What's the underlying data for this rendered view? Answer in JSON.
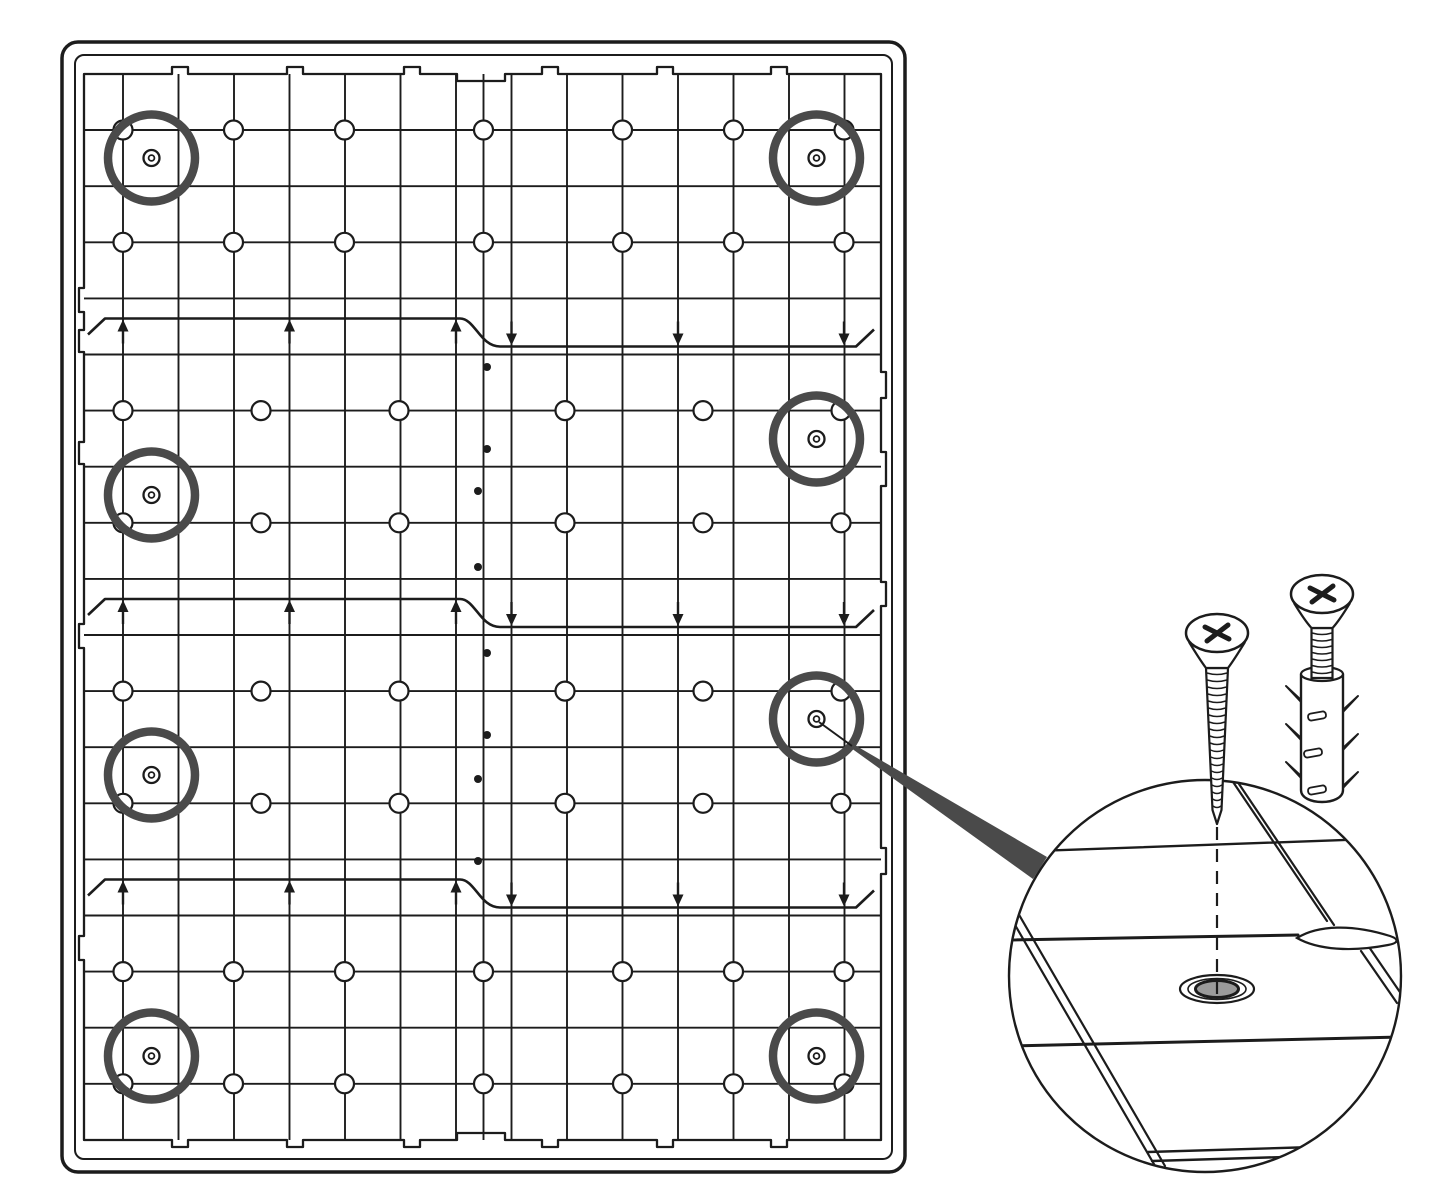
{
  "figure": {
    "type": "panel-mounting-instruction-diagram",
    "canvas": {
      "width": 1445,
      "height": 1200
    },
    "colors": {
      "background": "#ffffff",
      "line": "#1c1c1c",
      "accent": "#4a4a4a",
      "hole_fill": "#9b9b9b"
    },
    "style": {
      "grid_stroke": 1.9,
      "tile_stroke": 2.3,
      "joint_stroke": 2.6,
      "outer_frame_stroke": 3.5,
      "inner_frame_stroke": 2,
      "detail_circle_stroke": 2.4
    },
    "panel": {
      "outer_frame": {
        "x": 62,
        "y": 42,
        "w": 843,
        "h": 1130,
        "radius": 16
      },
      "inner_frame": {
        "x": 75,
        "y": 55,
        "w": 817,
        "h": 1104,
        "radius": 9
      },
      "tile_area": {
        "x": 84,
        "y": 74,
        "w": 797,
        "h": 1066
      },
      "edge_features": {
        "tab_depth": 7,
        "tab_halfwidth": 8,
        "step_out": 5,
        "top": [
          {
            "tab": 180
          },
          {
            "tab": 295
          },
          {
            "tab": 412
          },
          {
            "recess": [
              457,
              505
            ]
          },
          {
            "tab": 550
          },
          {
            "tab": 665
          },
          {
            "tab": 779
          }
        ],
        "right_steps": [
          [
            372,
            398
          ],
          [
            452,
            486
          ],
          [
            582,
            606
          ],
          [
            848,
            874
          ]
        ],
        "left_steps": [
          [
            288,
            312
          ],
          [
            330,
            352
          ],
          [
            442,
            464
          ],
          [
            624,
            648
          ],
          [
            936,
            960
          ]
        ]
      },
      "grid": {
        "vertical_lines_x": [
          123,
          178.5,
          234,
          289.5,
          345,
          400.5,
          456,
          511.5,
          567,
          622.5,
          678,
          733.5,
          789,
          844.5
        ],
        "seam_x": 483.5,
        "horizontal_lines_y": [
          130,
          186.2,
          242.3,
          298.4,
          354.5,
          410.6,
          466.7,
          522.8,
          578.9,
          635,
          691.1,
          747.2,
          803.3,
          859.4,
          915.5,
          971.6,
          1027.7,
          1083.8
        ]
      },
      "section_boundaries": [
        {
          "left_y": 318.5,
          "right_y": 346.5
        },
        {
          "left_y": 599,
          "right_y": 627
        },
        {
          "left_y": 879.5,
          "right_y": 907.5
        }
      ],
      "boundary_shape": {
        "x_start": 88,
        "step_x1": 460,
        "step_x2": 500,
        "x_end": 856,
        "up_arrow_xs": [
          123,
          289.5,
          456
        ],
        "down_arrow_xs": [
          511.5,
          678,
          844
        ]
      },
      "peg_circles": {
        "radius": 9.5,
        "rows_wide": [
          130,
          242.3,
          971.6,
          1083.8
        ],
        "cols_wide": [
          123,
          233.5,
          344.5,
          483.5,
          622.5,
          733.5,
          844
        ],
        "rows_narrow": [
          410.6,
          522.8,
          691.1,
          803.3
        ],
        "cols_narrow": [
          123,
          261,
          399,
          565,
          703,
          841
        ]
      },
      "seam_dots": [
        [
          487,
          367
        ],
        [
          487,
          449
        ],
        [
          478,
          491
        ],
        [
          478,
          567
        ],
        [
          487,
          653
        ],
        [
          487,
          735
        ],
        [
          478,
          779
        ],
        [
          478,
          861
        ]
      ],
      "screw_positions": {
        "ring_radius": 43.5,
        "ring_stroke": 8.5,
        "marker_outer_r": 8,
        "marker_inner_r": 2.9,
        "centers": [
          [
            151.5,
            158
          ],
          [
            816.5,
            158
          ],
          [
            816.5,
            439
          ],
          [
            151.5,
            495
          ],
          [
            816.5,
            719
          ],
          [
            151.5,
            775
          ],
          [
            151.5,
            1056
          ],
          [
            816.5,
            1056
          ]
        ]
      }
    },
    "callout": {
      "leader": {
        "x1": 819,
        "y1": 722,
        "x2": 852,
        "y2": 746
      },
      "wedge": [
        [
          853,
          744
        ],
        [
          851,
          748
        ],
        [
          1033,
          879
        ],
        [
          1047,
          857
        ]
      ]
    },
    "detail_view": {
      "circle": {
        "cx": 1205,
        "cy": 976,
        "r": 196
      },
      "board_lines": [
        {
          "x1": 1008,
          "y1": 852,
          "x2": 1400,
          "y2": 838,
          "w": 2.4
        },
        {
          "x1": 1008,
          "y1": 940,
          "x2": 1298,
          "y2": 935,
          "w": 3
        },
        {
          "x1": 1390,
          "y1": 941,
          "x2": 1403,
          "y2": 942,
          "w": 2.4
        },
        {
          "x1": 1010,
          "y1": 1046,
          "x2": 1400,
          "y2": 1037,
          "w": 3
        },
        {
          "x1": 1148,
          "y1": 1152,
          "x2": 1314,
          "y2": 1147,
          "w": 2.4
        },
        {
          "x1": 1152,
          "y1": 1161,
          "x2": 1316,
          "y2": 1156,
          "w": 2.4
        }
      ],
      "diagonals": [
        {
          "x1": 1229,
          "y1": 776,
          "x2": 1327,
          "y2": 921
        },
        {
          "x1": 1237,
          "y1": 781,
          "x2": 1334,
          "y2": 925
        },
        {
          "x1": 1361,
          "y1": 951,
          "x2": 1397,
          "y2": 1003
        },
        {
          "x1": 1369,
          "y1": 947,
          "x2": 1404,
          "y2": 998
        },
        {
          "x1": 1004,
          "y1": 906,
          "x2": 1158,
          "y2": 1171
        },
        {
          "x1": 1011,
          "y1": 901,
          "x2": 1165,
          "y2": 1166
        }
      ],
      "lens_path": "M1297,938 C1318,925 1352,924 1390,936 C1399,939 1399,943 1388,945 C1352,952 1318,950 1297,938 Z",
      "hole": {
        "cx": 1217,
        "cy": 989,
        "outer_rx": 37,
        "outer_ry": 14,
        "mid_rx": 29,
        "mid_ry": 10.5,
        "inner_rx": 21.5,
        "inner_ry": 8.5
      },
      "dashed_line": {
        "x": 1217,
        "y1": 827,
        "y2": 1001,
        "dash": "13 9"
      },
      "screw": {
        "cx": 1217,
        "head_cy": 633,
        "neck_y": 668,
        "tip_y": 824,
        "top_hw": 11,
        "tip_hw": 4.5,
        "thread_step": 7
      },
      "plug_screw": {
        "cx": 1322,
        "head_cy": 594,
        "neck_y": 628,
        "shaft_hw": 10.5,
        "shaft_bottom": 678,
        "thread_step": 6.5
      },
      "plug": {
        "cx": 1322,
        "top_y": 674,
        "bottom_y": 798,
        "hw": 21,
        "collar_ry": 7,
        "barbs_left_y": [
          702,
          740,
          778
        ],
        "barbs_right_y": [
          712,
          750,
          788
        ],
        "slots": [
          [
            1317,
            716
          ],
          [
            1313,
            753
          ],
          [
            1317,
            790
          ]
        ]
      }
    }
  }
}
